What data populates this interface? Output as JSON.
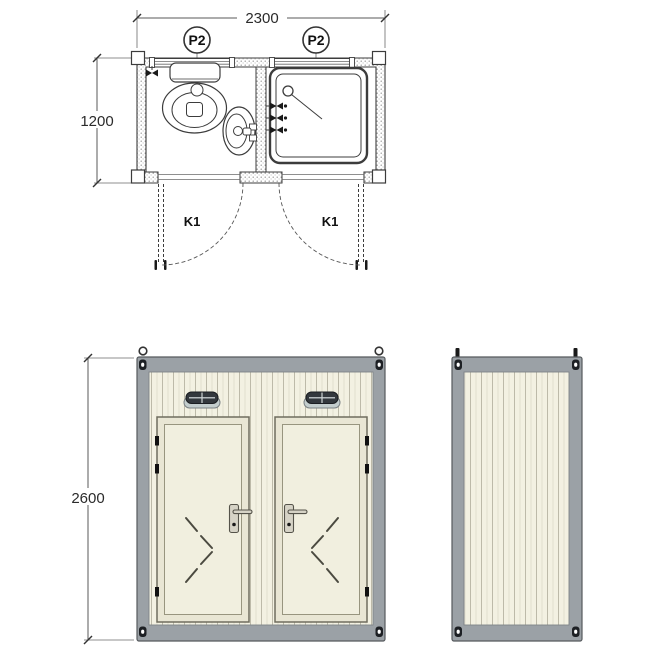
{
  "plan_view": {
    "width_dimension": "2300",
    "depth_dimension": "1200",
    "window_tag_left": "P2",
    "window_tag_right": "P2",
    "door_tag_left": "K1",
    "door_tag_right": "K1"
  },
  "front_elevation": {
    "height_dimension": "2600"
  },
  "colors": {
    "frame_gray": "#9ba1a6",
    "frame_edge": "#565a5e",
    "panel_cream": "#f3f1e2",
    "stripe": "#bdbaa9",
    "door_frame_fill": "#e9e6d4",
    "door_leaf_fill": "#f1efdf",
    "vent_dark": "#33383d",
    "vent_base": "#c3cdcd",
    "line_dark": "#3c3c3c"
  }
}
